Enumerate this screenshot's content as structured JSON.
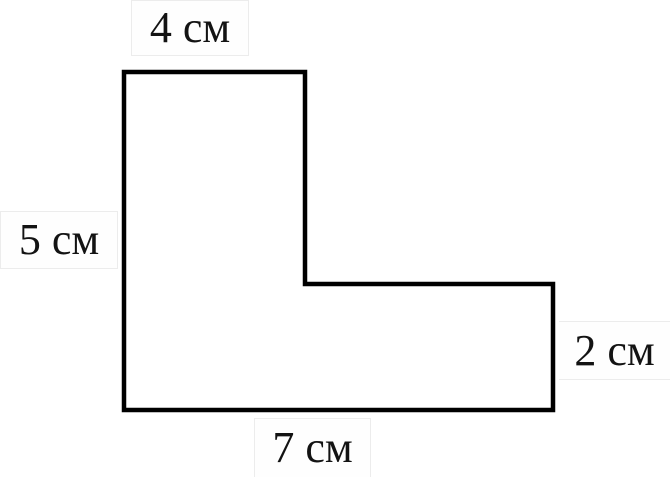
{
  "figure": {
    "description": "L-shaped rectilinear polygon with side length labels",
    "unit": "см",
    "labels": {
      "top": "4 см",
      "left": "5 см",
      "right": "2 см",
      "bottom": "7 см"
    },
    "dimensions": {
      "top_side_cm": 4,
      "left_side_cm": 5,
      "right_side_cm": 2,
      "bottom_side_cm": 7
    },
    "colors": {
      "outline": "#000000",
      "background": "#ffffff",
      "label_text": "#131313",
      "label_border": "#ececec"
    }
  }
}
